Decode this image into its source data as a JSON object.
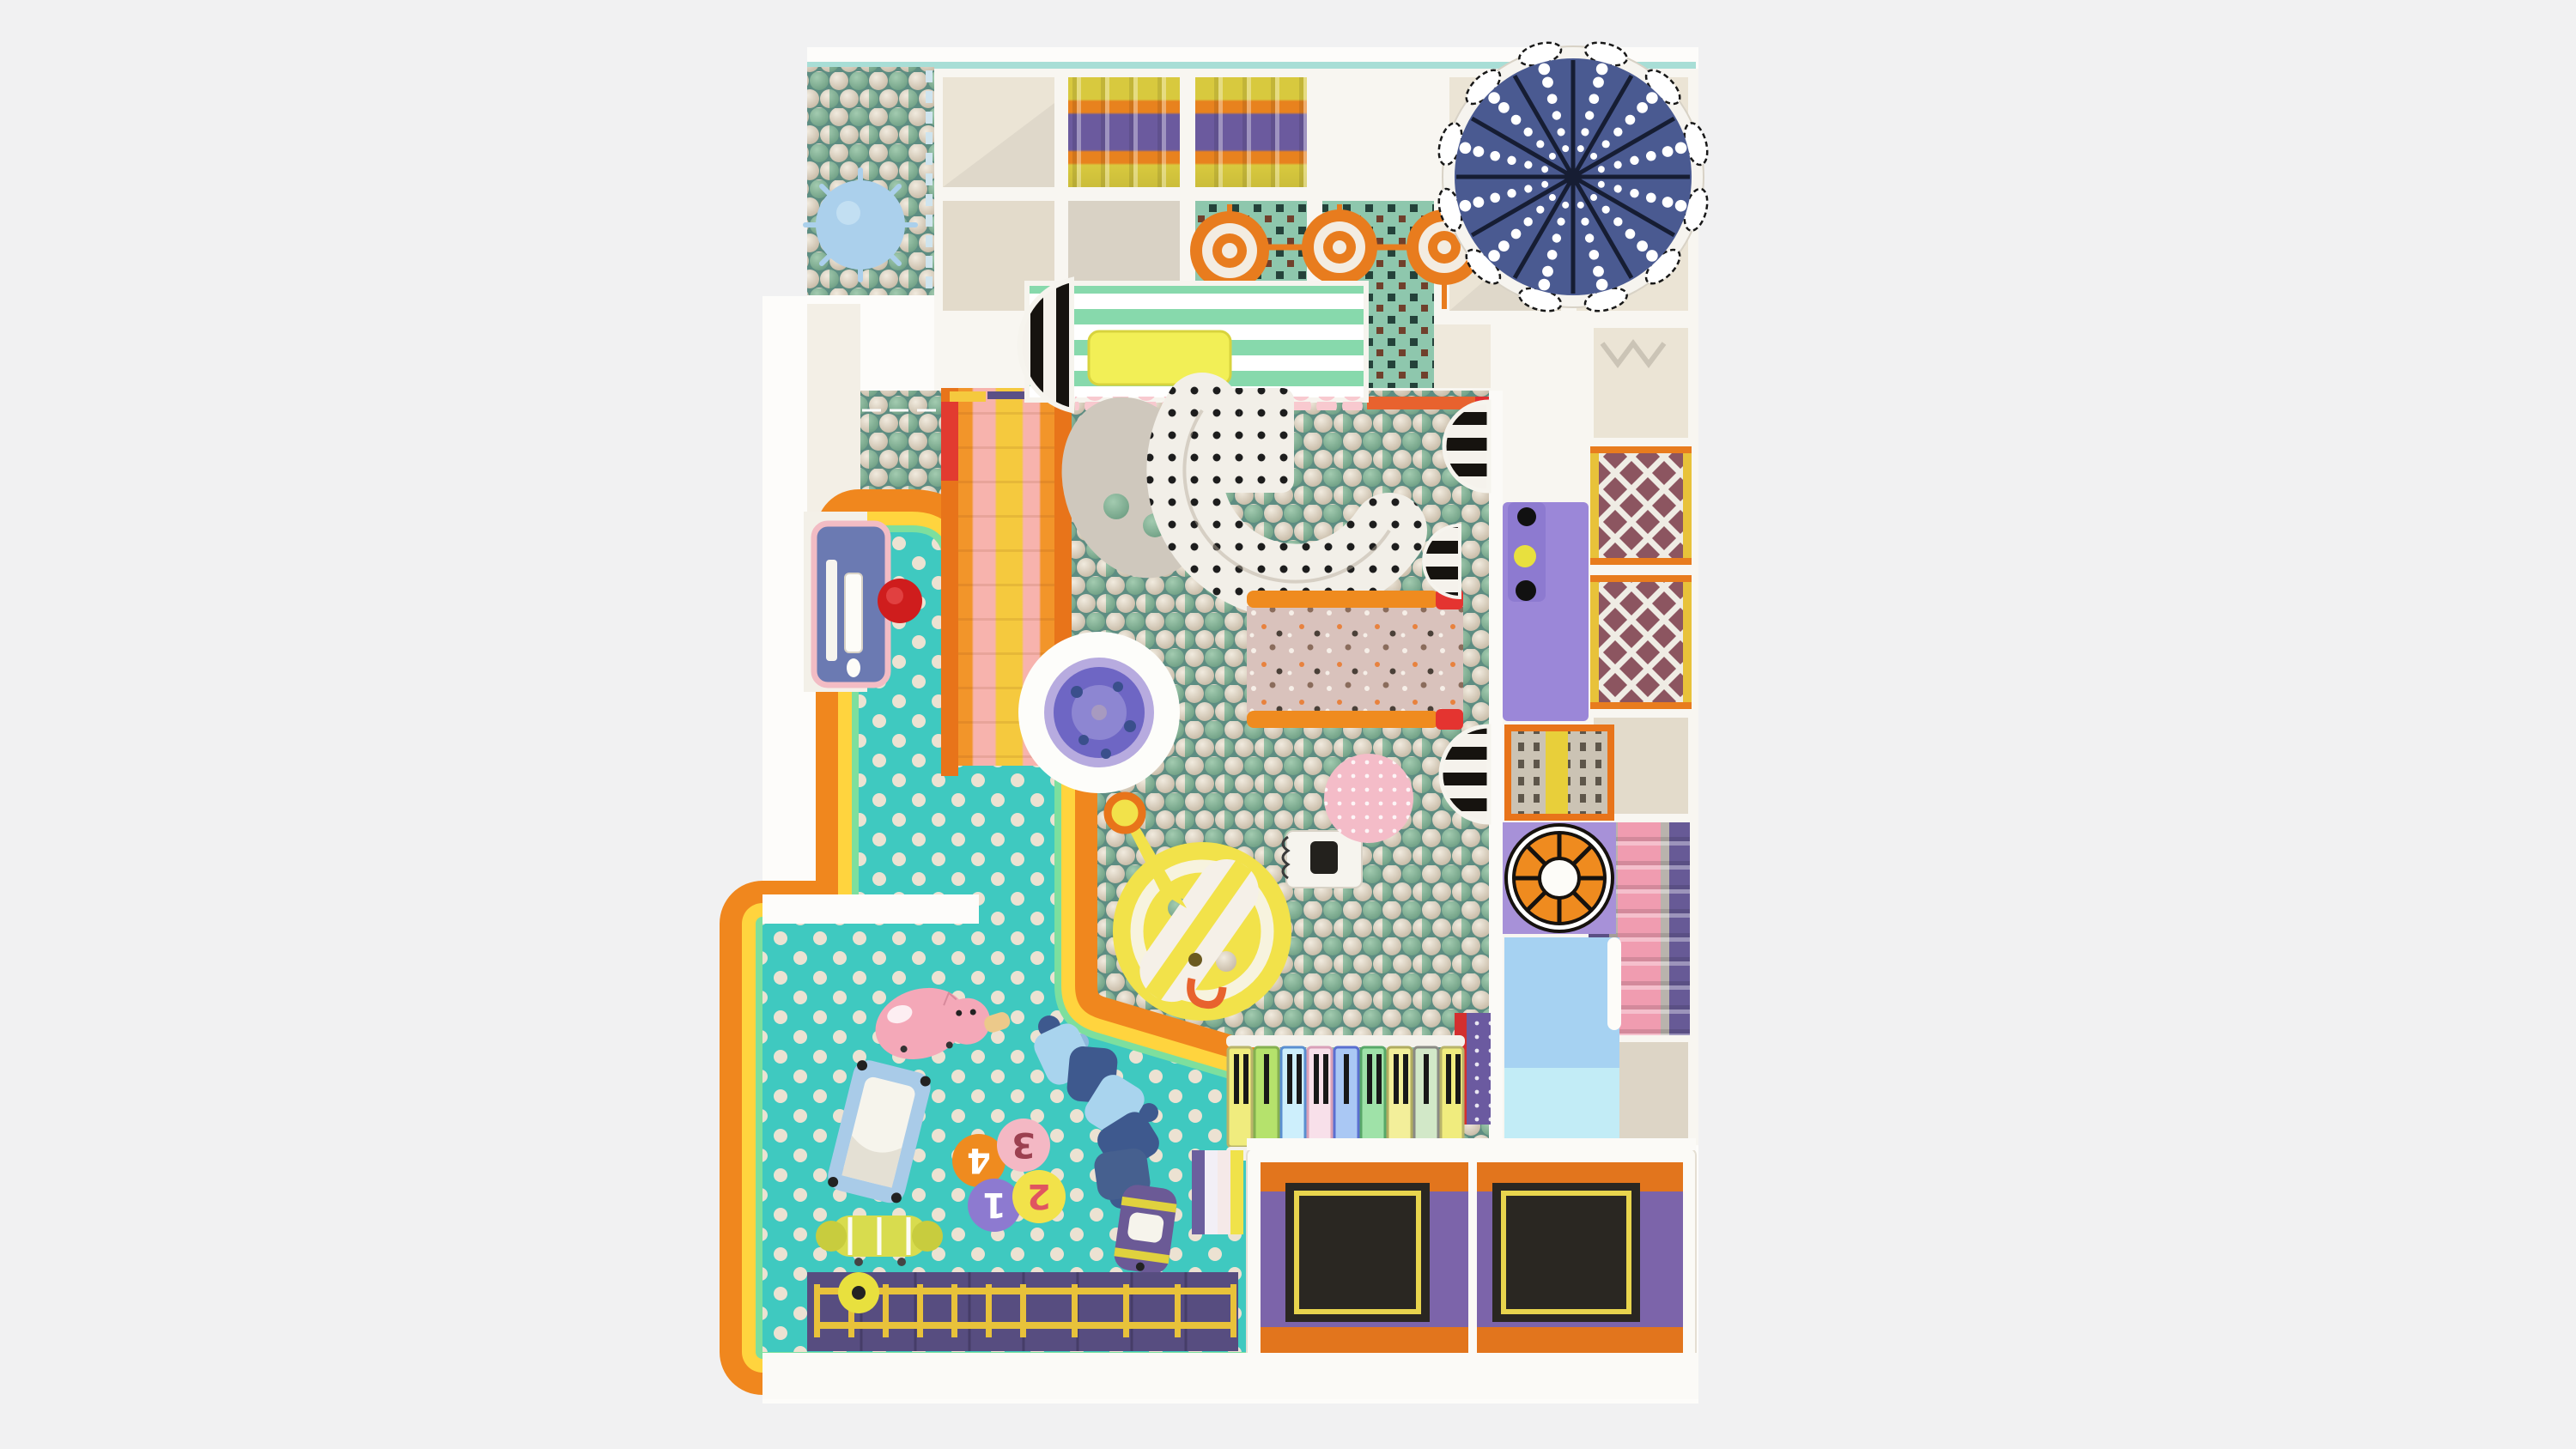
{
  "scene": {
    "description": "Top-down render of an indoor soft-play playground floor plan",
    "background": "#f1f1f2",
    "plate": "#fdfcfa"
  },
  "colors": {
    "grid_frame": "#f8f6f1",
    "grid_panel": "#ebe4d5",
    "top_wall_mint": "#a8ded6",
    "umbrella_navy": "#4a5a91",
    "umbrella_line": "#161d33",
    "ballpit_base": "#5d8d82",
    "ball_green": "#8bbc9e",
    "ball_cream": "#ddd2c2",
    "toddler_floor": "#3fc9c0",
    "floor_dot": "#ece2d2",
    "border_orange": "#f0871e",
    "border_yellow": "#ffd43e",
    "border_mint": "#7ddf9e",
    "canopy_mint": "#87d9ac",
    "stair_orange": "#f2952a",
    "stair_pink": "#f7b3ad",
    "stair_yellow": "#f5c93e",
    "roller_yellow": "#d8c93e",
    "roller_orange": "#e8821e",
    "roller_purple": "#6b5a9e",
    "target_teal": "#8ec7ad",
    "target_orange": "#e87c1e",
    "pink_roller": "#f6b9c5",
    "purple_mat": "#9b87d8",
    "climb_panel": "#cbc3b4",
    "wheel_orange": "#ef8b1f",
    "runout_blue": "#a6d2f2",
    "runout_cyan": "#c2ecf6",
    "slide_pink_terrazzo": "#d9c2bc",
    "pool_white": "#fdfdfa",
    "pool_ring": "#b7abdf",
    "pool_purple": "#6e66c4",
    "sub_yellow": "#f2e24a",
    "pig_pink": "#f4a8b8",
    "trampoline_orange": "#e2751d",
    "trampoline_purple": "#7c64aa",
    "trampoline_mat": "#2a2722",
    "trampoline_mat_border": "#e8d44d",
    "wall_purple": "#574d80",
    "fence_yellow": "#e8c23a",
    "desk_blue": "#6b7ab2",
    "desk_trim_pink": "#f2bcc4",
    "stool_red": "#cf1d1d",
    "spiky_ball_blue": "#abd0ec",
    "caterpillar_light": "#a9d4ee",
    "caterpillar_dark": "#3e598e",
    "net_bg": "#8c5560",
    "slide_roller_pink": "#f09cb0",
    "tube_white": "#f2efe8"
  },
  "toddler": {
    "stools": [
      {
        "label": "4",
        "fill": "#ef8b1f",
        "text_color": "#ffffff"
      },
      {
        "label": "3",
        "fill": "#f4b8c4",
        "text_color": "#9c4050"
      },
      {
        "label": "1",
        "fill": "#8d7ad0",
        "text_color": "#ffffff"
      },
      {
        "label": "2",
        "fill": "#f2e24a",
        "text_color": "#e05560"
      }
    ]
  },
  "piano": {
    "keys": [
      "#f0ec7e",
      "#b5e26c",
      "#cdeffc",
      "#f8e0ea",
      "#aac8f4",
      "#9fe2a8",
      "#f3ef9a",
      "#d2e8c8",
      "#f0ec7e"
    ]
  }
}
